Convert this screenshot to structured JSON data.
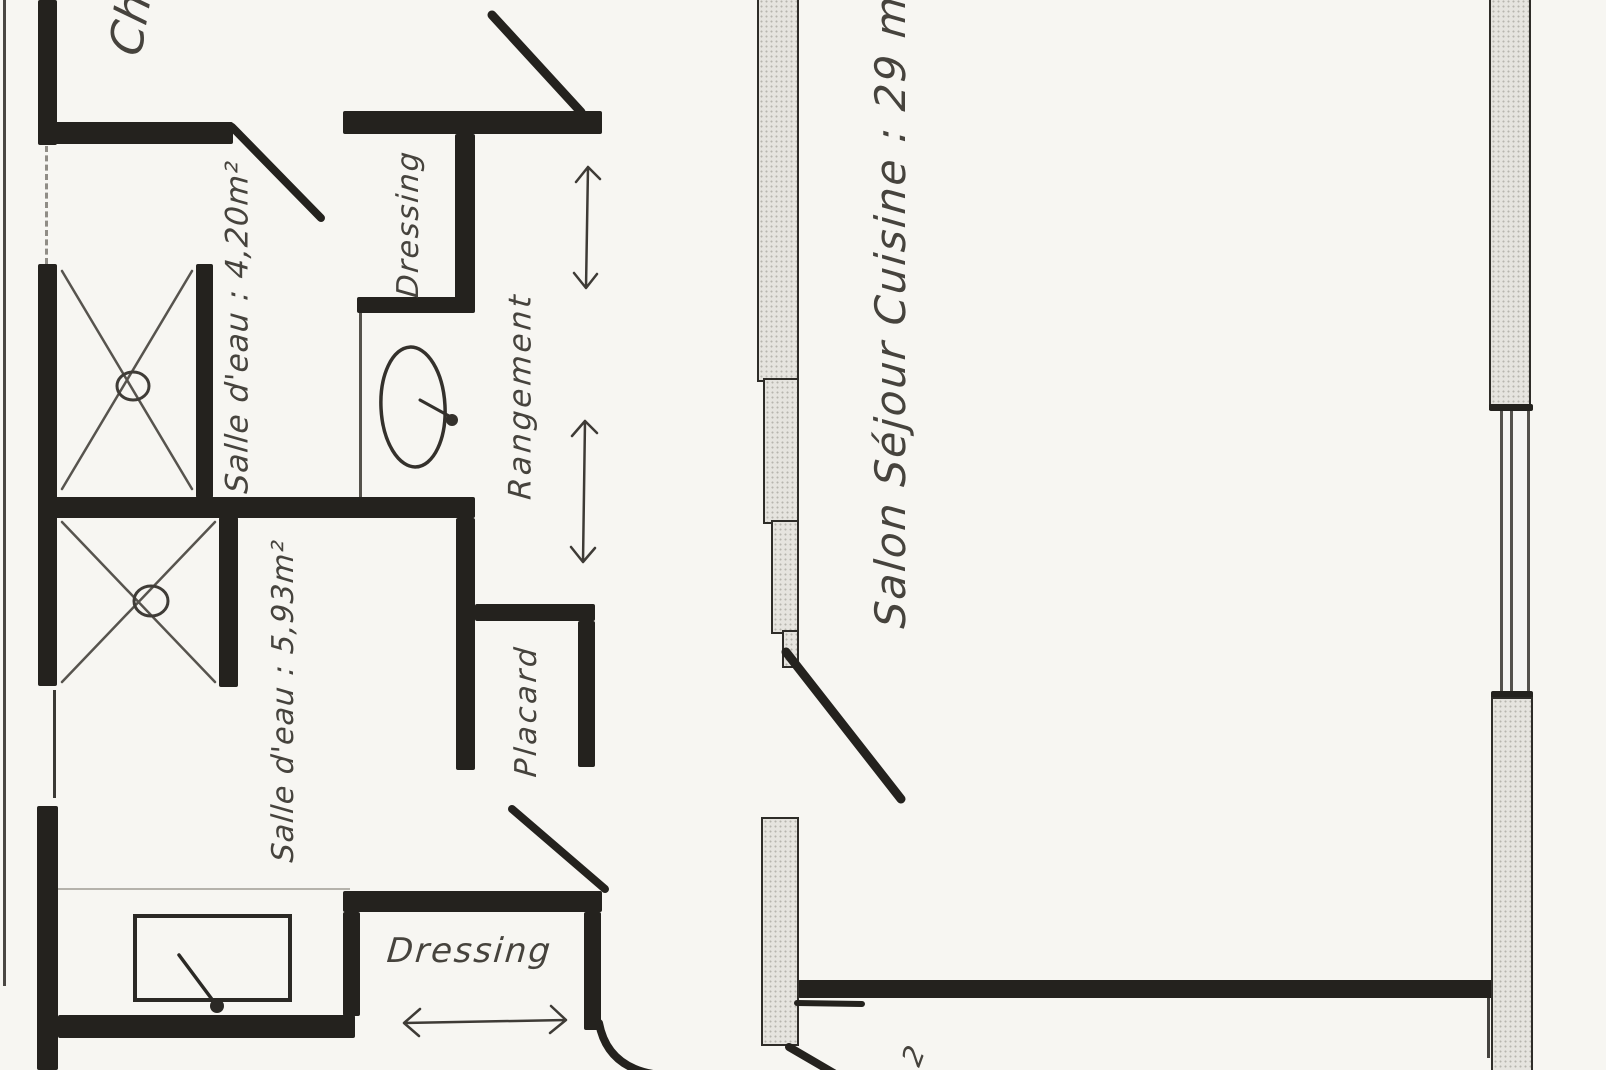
{
  "floorplan": {
    "labels": {
      "chambre_partial": "Ch",
      "salle_eau_1": "Salle d'eau : 4,20m²",
      "dressing_top": "Dressing",
      "rangement": "Rangement",
      "salle_eau_2": "Salle d'eau : 5,93m²",
      "placard": "Placard",
      "dressing_bottom": "Dressing",
      "salon": "Salon Séjour Cuisine : 29 m²",
      "superscript_partial": "2"
    },
    "colors": {
      "ink": "#24221e",
      "paper": "#f7f6f2",
      "wallfill": "#e6e4df",
      "pencil": "#46433d"
    },
    "symbols": [
      "shower-tray-icon",
      "shower-tray-icon",
      "washbasin-icon",
      "bathtub-icon",
      "door-swing-icon",
      "window-icon",
      "double-arrow-icon"
    ]
  }
}
